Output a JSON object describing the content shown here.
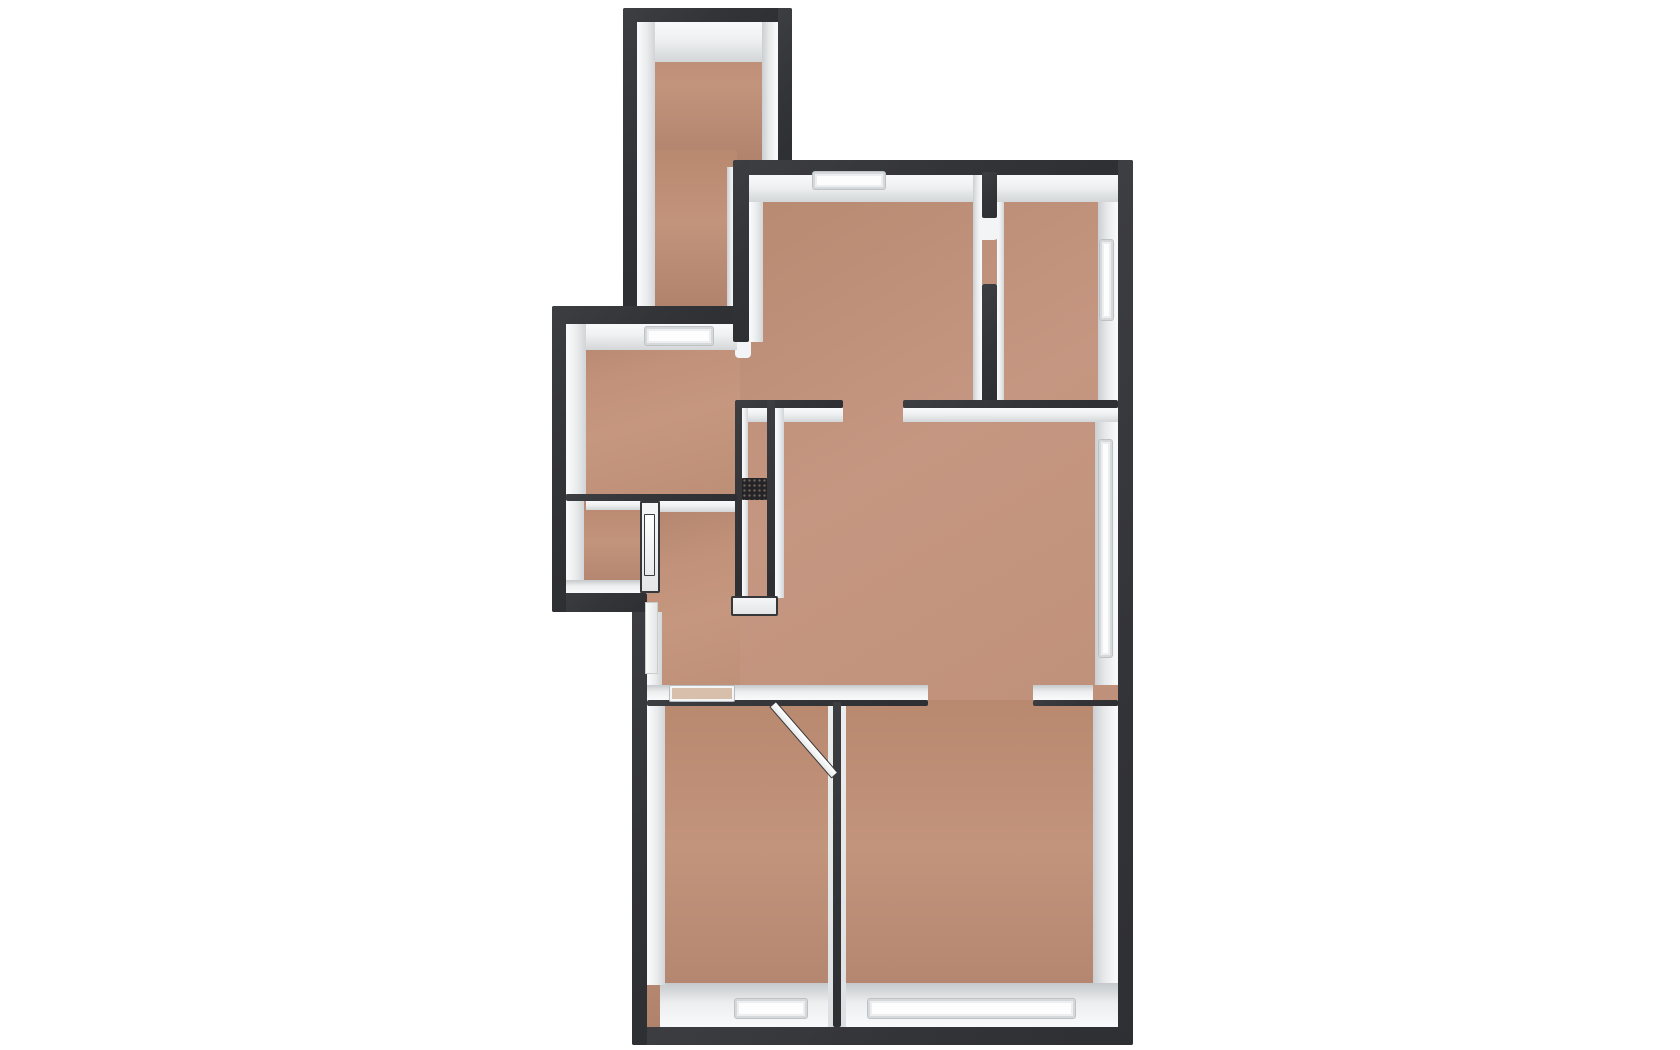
{
  "scene": {
    "type": "3d-floorplan-top-down-render",
    "description": "Unfurnished 3D dollhouse-style floor plan viewed from directly above: dark-capped walls with white inner faces and terracotta-tan floors on a plain white background",
    "background_color": "#ffffff"
  },
  "palette": {
    "wall_top": "#35363a",
    "wall_face_bright": "#f8f9fa",
    "wall_face_shadow": "#cccfd2",
    "floor_base": "#c19179",
    "floor_shadow": "#ab806c",
    "window_sill": "#fdfdfe",
    "door_threshold": "#d8bfab",
    "duct_shaft": "#242428"
  },
  "rooms": [
    {
      "id": "narrow-room-top-left",
      "position": "top-left",
      "shape": "tall-narrow"
    },
    {
      "id": "room-mid-left",
      "position": "middle-left",
      "shape": "rectangular"
    },
    {
      "id": "small-room-lower-left",
      "position": "lower-left",
      "shape": "small"
    },
    {
      "id": "hallway-center-left",
      "position": "center-left",
      "shape": "corridor"
    },
    {
      "id": "large-room-top-center",
      "position": "top-center",
      "shape": "large"
    },
    {
      "id": "room-top-right",
      "position": "top-right",
      "shape": "rectangular"
    },
    {
      "id": "open-living-area-center",
      "position": "center",
      "shape": "large-open"
    },
    {
      "id": "room-bottom-left",
      "position": "bottom-left",
      "shape": "rectangular"
    },
    {
      "id": "room-bottom-right",
      "position": "bottom-right",
      "shape": "rectangular"
    }
  ],
  "openings": {
    "windows": [
      {
        "id": "window-top-center-wall",
        "wall": "north",
        "room": "large-room-top-center"
      },
      {
        "id": "window-mid-left-wall",
        "wall": "interior-north",
        "room": "room-mid-left"
      },
      {
        "id": "window-top-right-wall",
        "wall": "east",
        "room": "room-top-right"
      },
      {
        "id": "window-living-east-wall",
        "wall": "east",
        "room": "open-living-area-center"
      },
      {
        "id": "window-bottom-left-wall",
        "wall": "south",
        "room": "room-bottom-left"
      },
      {
        "id": "window-bottom-right-wall",
        "wall": "south",
        "room": "room-bottom-right"
      }
    ],
    "doors": [
      {
        "id": "door-top-right-room",
        "state": "opening-with-jambs"
      },
      {
        "id": "door-small-room",
        "state": "closed-white-leaf"
      },
      {
        "id": "door-bottom-left-room",
        "state": "open-swung-into-room"
      },
      {
        "id": "passage-mid-left-to-living",
        "state": "open-passage"
      },
      {
        "id": "passage-living-to-bottom-right",
        "state": "open-passage"
      }
    ],
    "duct": {
      "id": "service-shaft-center",
      "appearance": "dark-hatched-cell"
    }
  }
}
